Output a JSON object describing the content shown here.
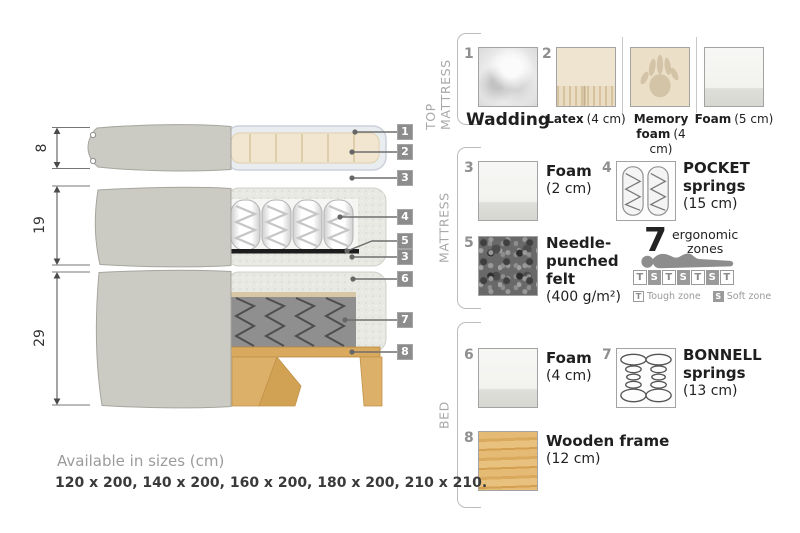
{
  "diagram": {
    "dim_top": "8",
    "dim_mid": "19",
    "dim_bottom": "29",
    "tags": [
      "1",
      "2",
      "3",
      "4",
      "5",
      "3",
      "6",
      "7",
      "8"
    ]
  },
  "panel": {
    "sections": [
      {
        "label": "TOP MATTRESS",
        "items": [
          {
            "num": "1",
            "name": "Wadding",
            "size": ""
          },
          {
            "num": "2",
            "name": "Latex",
            "size": "(4 cm)"
          },
          {
            "num": "",
            "name": "Memory foam",
            "size": "(4 cm)"
          },
          {
            "num": "",
            "name": "Foam",
            "size": "(5 cm)"
          }
        ]
      },
      {
        "label": "MATTRESS",
        "items": [
          {
            "num": "3",
            "name": "Foam",
            "size": "(2 cm)"
          },
          {
            "num": "4",
            "name": "POCKET springs",
            "size": "(15 cm)"
          },
          {
            "num": "5",
            "name": "Needle-punched felt",
            "size": "(400 g/m²)"
          }
        ]
      },
      {
        "label": "BED",
        "items": [
          {
            "num": "6",
            "name": "Foam",
            "size": "(4 cm)"
          },
          {
            "num": "7",
            "name": "BONNELL springs",
            "size": "(13 cm)"
          },
          {
            "num": "8",
            "name": "Wooden frame",
            "size": "(12 cm)"
          }
        ]
      }
    ]
  },
  "ergonomic": {
    "number": "7",
    "word1": "ergonomic",
    "word2": "zones",
    "zones": [
      "T",
      "S",
      "T",
      "S",
      "T",
      "S",
      "T"
    ],
    "legend": [
      {
        "key": "T",
        "label": "Tough zone"
      },
      {
        "key": "S",
        "label": "Soft zone"
      }
    ]
  },
  "footer": {
    "title": "Available in sizes (cm)",
    "sizes": "120 x 200, 140 x 200, 160 x 200, 180 x 200, 210 x 210."
  },
  "colors": {
    "tag_bg": "#8c8c8c",
    "fabric_gray": "#cbcbc4",
    "latex_beige": "#f2e6d0",
    "wood": "#d9a95e",
    "felt_black": "#1c1c1c"
  }
}
